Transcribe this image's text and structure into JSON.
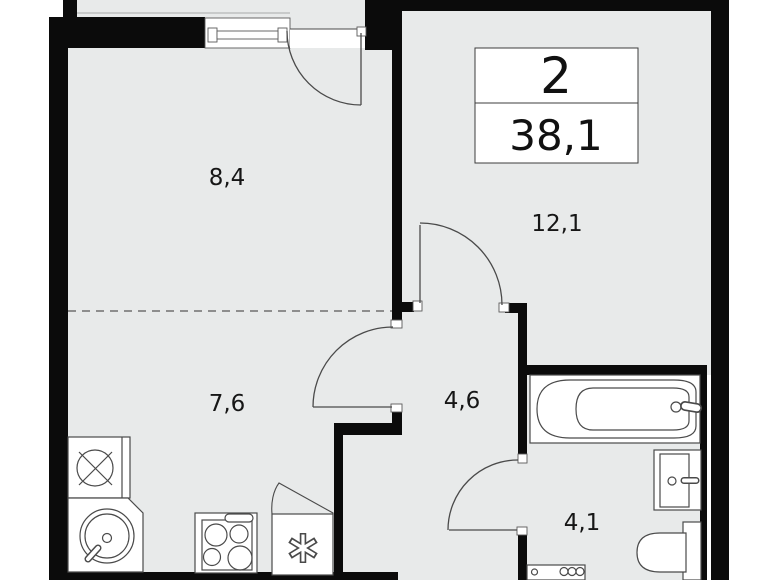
{
  "plan": {
    "unit": {
      "rooms_count": "2",
      "total_area": "38,1"
    },
    "rooms": [
      {
        "id": "bedroom",
        "label": "8,4"
      },
      {
        "id": "living",
        "label": "12,1"
      },
      {
        "id": "kitchen",
        "label": "7,6"
      },
      {
        "id": "hallway",
        "label": "4,6"
      },
      {
        "id": "bathroom",
        "label": "4,1"
      }
    ],
    "fixtures": [
      "window",
      "balcony-door",
      "washing-machine",
      "kitchen-sink",
      "stove",
      "fridge-freezer",
      "bathtub",
      "wash-basin",
      "toilet",
      "washer-dryer",
      "door-swing-living",
      "door-swing-kitchen",
      "door-swing-bathroom"
    ],
    "colors": {
      "floor": "#e8eaea",
      "wall": "#0b0b0b",
      "outline": "#4a4a4a",
      "background": "#ffffff",
      "text": "#161616"
    }
  }
}
